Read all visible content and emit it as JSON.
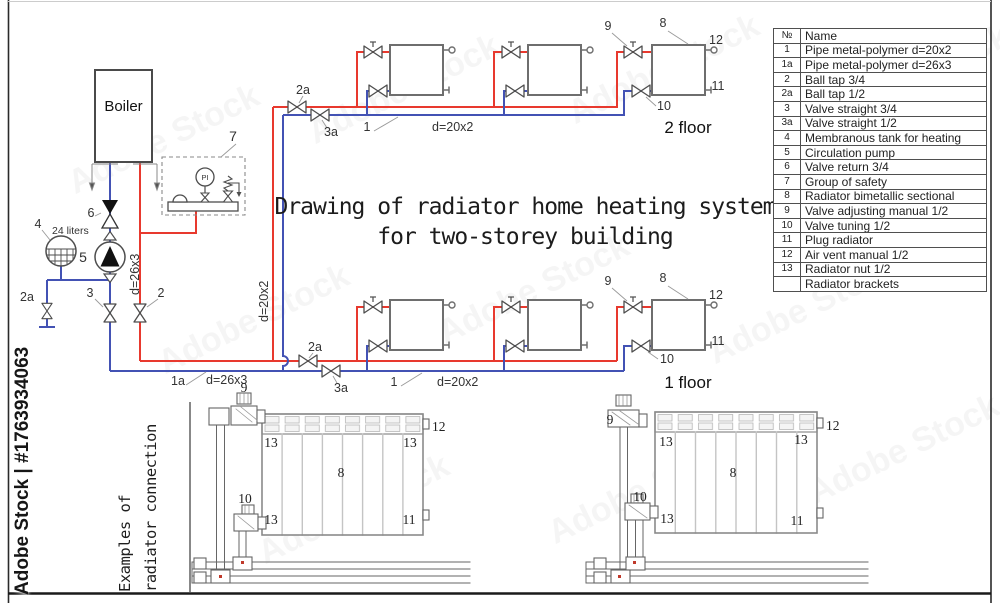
{
  "watermark": {
    "brand": "Adobe Stock | #1763934063",
    "ghost": "Adobe Stock"
  },
  "title": {
    "line1": "Drawing of radiator home heating system",
    "line2": "for two-storey building"
  },
  "caption": {
    "line1": "Examples of",
    "line2": "radiator connection"
  },
  "diagram": {
    "boiler": "Boiler",
    "tank_capacity": "24 liters",
    "gauge": "PI",
    "floor2": "2 floor",
    "floor1": "1 floor",
    "d20": "d=20x2",
    "d26": "d=26x3"
  },
  "callouts": {
    "n1": "1",
    "n1a": "1a",
    "n2": "2",
    "n2a": "2a",
    "n3": "3",
    "n3a": "3a",
    "n4": "4",
    "n5": "5",
    "n6": "6",
    "n7": "7",
    "n8": "8",
    "n9": "9",
    "n10": "10",
    "n11": "11",
    "n12": "12",
    "n13": "13"
  },
  "table": {
    "headers": {
      "num": "№",
      "name": "Name"
    },
    "rows": [
      {
        "num": "1",
        "name": "Pipe metal-polymer d=20x2"
      },
      {
        "num": "1a",
        "name": "Pipe metal-polymer d=26x3"
      },
      {
        "num": "2",
        "name": "Ball tap 3/4"
      },
      {
        "num": "2a",
        "name": "Ball tap 1/2"
      },
      {
        "num": "3",
        "name": "Valve straight 3/4"
      },
      {
        "num": "3a",
        "name": "Valve straight 1/2"
      },
      {
        "num": "4",
        "name": "Membranous tank for heating"
      },
      {
        "num": "5",
        "name": "Circulation pump"
      },
      {
        "num": "6",
        "name": "Valve return 3/4"
      },
      {
        "num": "7",
        "name": "Group of safety"
      },
      {
        "num": "8",
        "name": "Radiator bimetallic sectional"
      },
      {
        "num": "9",
        "name": "Valve adjusting manual 1/2"
      },
      {
        "num": "10",
        "name": "Valve tuning 1/2"
      },
      {
        "num": "11",
        "name": "Plug radiator"
      },
      {
        "num": "12",
        "name": "Air vent manual 1/2"
      },
      {
        "num": "13",
        "name": "Radiator nut 1/2"
      },
      {
        "num": "",
        "name": "Radiator brackets"
      }
    ]
  }
}
